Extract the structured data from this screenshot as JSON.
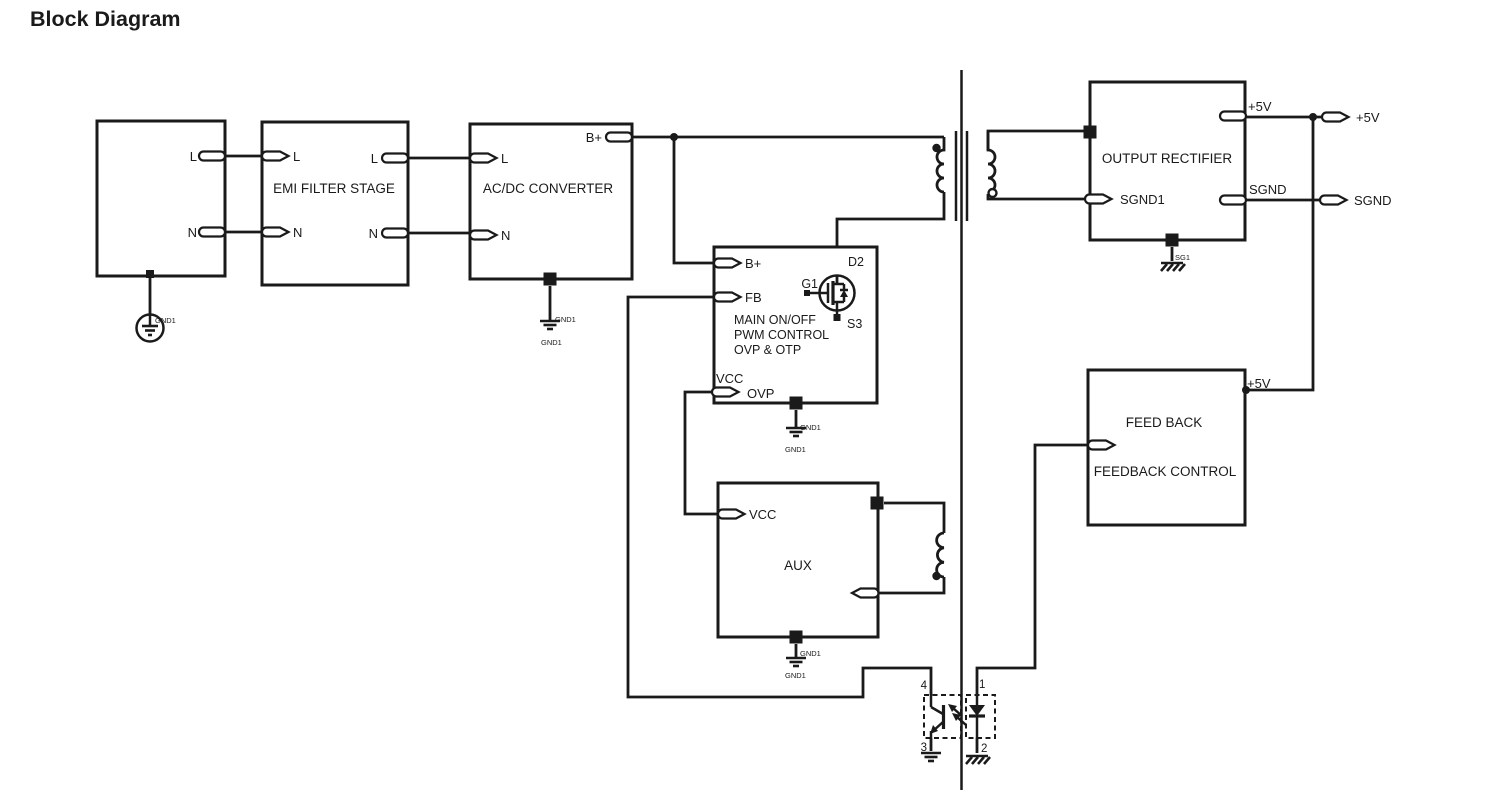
{
  "title": {
    "text": "Block Diagram",
    "color": "#189CDC"
  },
  "colors": {
    "line": "#1a1a1a",
    "background": "#ffffff"
  },
  "blocks": {
    "ac_input": {
      "ports": {
        "l": "L",
        "n": "N"
      },
      "ground_label": "GND1"
    },
    "emi_filter": {
      "label": "EMI FILTER STAGE",
      "ports": {
        "l_in": "L",
        "n_in": "N",
        "l_out": "L",
        "n_out": "N"
      }
    },
    "acdc_converter": {
      "label": "AC/DC CONVERTER",
      "ports": {
        "l": "L",
        "n": "N",
        "b_plus": "B+"
      },
      "ground": {
        "side": "GND1",
        "below": "GND1"
      }
    },
    "pwm_control": {
      "label_lines": [
        "MAIN ON/OFF",
        "PWM CONTROL",
        "OVP & OTP"
      ],
      "ports": {
        "b_plus": "B+",
        "fb": "FB",
        "vcc": "VCC",
        "ovp": "OVP"
      },
      "mosfet": {
        "drain": "D2",
        "gate": "G1",
        "source": "S3"
      },
      "ground": {
        "side": "GND1",
        "below": "GND1"
      }
    },
    "aux": {
      "label": "AUX",
      "ports": {
        "vcc": "VCC"
      },
      "ground": {
        "side": "GND1",
        "below": "GND1"
      }
    },
    "output_rectifier": {
      "label": "OUTPUT RECTIFIER",
      "ports": {
        "sgnd1": "SGND1",
        "p5v": "+5V",
        "sgnd": "SGND"
      },
      "ground_label": "SG1"
    },
    "feedback": {
      "label_lines": [
        "FEED BACK",
        "FEEDBACK CONTROL"
      ],
      "corner_label": "+5V"
    }
  },
  "terminals": {
    "p5v": "+5V",
    "sgnd": "SGND"
  },
  "optocoupler": {
    "pin1": "1",
    "pin2": "2",
    "pin3": "3",
    "pin4": "4"
  }
}
